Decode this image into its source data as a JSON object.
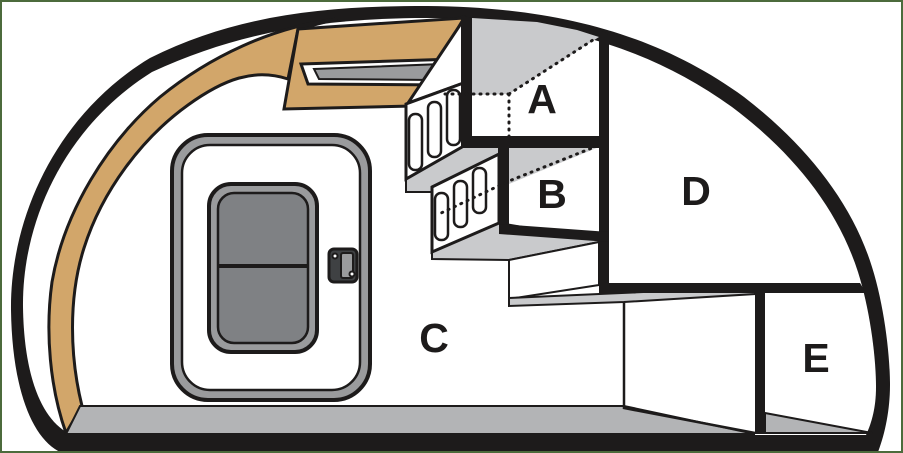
{
  "diagram": {
    "description": "Cross-section schematic of a rounded cabin with door, overhead bins and labeled storage compartments",
    "compartments": [
      "A",
      "B",
      "C",
      "D",
      "E"
    ],
    "labels": {
      "a": "A",
      "b": "B",
      "c": "C",
      "d": "D",
      "e": "E"
    }
  },
  "colors": {
    "outline": "#1d1b1b",
    "tan": "#d2a66a",
    "floor_gray": "#b3b4b6",
    "panel_gray": "#c9cacc",
    "vent_gray": "#9a9b9d",
    "glass_gray": "#7f8184",
    "latch_dark": "#3f4143",
    "border_green": "#4c6b3c",
    "background": "#ffffff"
  }
}
